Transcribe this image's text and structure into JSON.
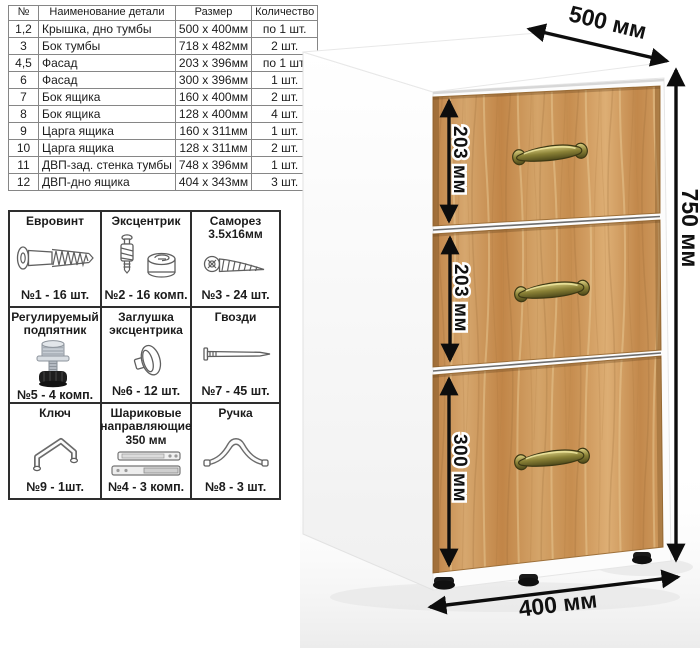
{
  "parts_table": {
    "headers": [
      "№",
      "Наименование детали",
      "Размер",
      "Количество"
    ],
    "rows": [
      {
        "num": "1,2",
        "name": "Крышка, дно тумбы",
        "size": "500 x 400мм",
        "qty": "по 1 шт."
      },
      {
        "num": "3",
        "name": "Бок тумбы",
        "size": "718 x 482мм",
        "qty": "2 шт."
      },
      {
        "num": "4,5",
        "name": "Фасад",
        "size": "203 x 396мм",
        "qty": "по 1 шт."
      },
      {
        "num": "6",
        "name": "Фасад",
        "size": "300 x 396мм",
        "qty": "1 шт."
      },
      {
        "num": "7",
        "name": "Бок ящика",
        "size": "160 x 400мм",
        "qty": "2 шт."
      },
      {
        "num": "8",
        "name": "Бок ящика",
        "size": "128 x 400мм",
        "qty": "4 шт."
      },
      {
        "num": "9",
        "name": "Царга ящика",
        "size": "160 x 311мм",
        "qty": "1 шт."
      },
      {
        "num": "10",
        "name": "Царга ящика",
        "size": "128 x 311мм",
        "qty": "2 шт."
      },
      {
        "num": "11",
        "name": "ДВП-зад. стенка тумбы",
        "size": "748 x 396мм",
        "qty": "1 шт."
      },
      {
        "num": "12",
        "name": "ДВП-дно ящика",
        "size": "404 x 343мм",
        "qty": "3 шт."
      }
    ]
  },
  "hardware": {
    "items": [
      {
        "title": "Евровинт",
        "qty": "№1 - 16 шт."
      },
      {
        "title": "Эксцентрик",
        "qty": "№2 - 16 комп."
      },
      {
        "title": "Саморез 3.5х16мм",
        "qty": "№3 - 24 шт."
      },
      {
        "title": "Регулируемый подпятник",
        "qty": "№5 - 4 комп."
      },
      {
        "title": "Заглушка эксцентрика",
        "qty": "№6 - 12 шт."
      },
      {
        "title": "Гвозди",
        "qty": "№7 - 45 шт."
      },
      {
        "title": "Ключ",
        "qty": "№9 - 1шт."
      },
      {
        "title": "Шариковые направляющие 350 мм",
        "qty": "№4 - 3 комп."
      },
      {
        "title": "Ручка",
        "qty": "№8 - 3 шт."
      }
    ]
  },
  "cabinet": {
    "dimensions": {
      "depth": "500 мм",
      "height": "750 мм",
      "width": "400 мм",
      "drawer_heights": [
        "203 мм",
        "203 мм",
        "300 мм"
      ]
    },
    "colors": {
      "wood": "#cf9a5e",
      "wood_dark": "#a5763d",
      "handle_brass": "#8a8136",
      "dimension_line": "#0d0d0d",
      "table_border": "#868686",
      "grid_border": "#2e2e2e"
    }
  }
}
